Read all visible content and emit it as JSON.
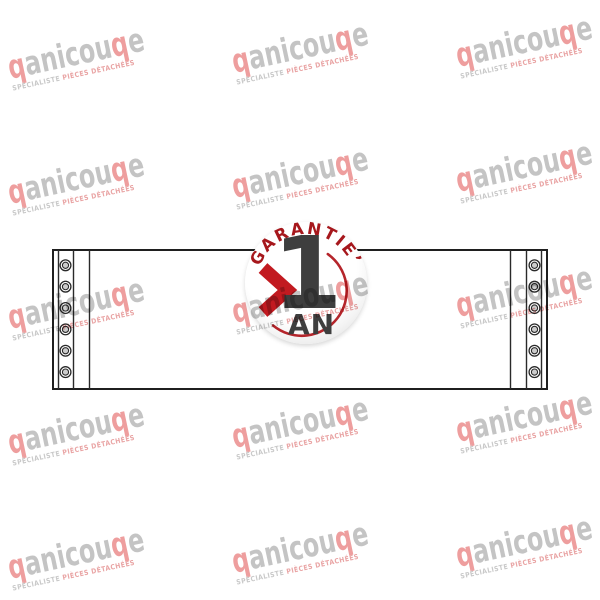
{
  "background": "#ffffff",
  "badge": {
    "arc_text": "GARANTIE’",
    "number": "1",
    "unit": "AN",
    "colors": {
      "arc_text": "#a6171c",
      "chevron": "#c21a20",
      "number": "#3e3e3e",
      "ring": "#b5252b"
    }
  },
  "watermark": {
    "word": [
      {
        "text": "p",
        "color": "red",
        "mirrored": true
      },
      {
        "text": "anicou",
        "color": "gray",
        "mirrored": false
      },
      {
        "text": "p",
        "color": "red",
        "mirrored": true
      },
      {
        "text": "e",
        "color": "gray",
        "mirrored": false
      }
    ],
    "subtitle": [
      {
        "text": "SPÉCIALISTE ",
        "color": "gray"
      },
      {
        "text": "PIÈCES DÉTACHÉES",
        "color": "red"
      }
    ],
    "colors": {
      "gray": "#c4c4c4",
      "red": "#ee9e9e",
      "subtitle_gray": "#c9c9c9",
      "subtitle_red": "#e9a4a4"
    }
  },
  "drawing": {
    "holes_per_side": 6,
    "line_color": "#2a2a2a",
    "hole_fill": "#cdcdcd"
  }
}
